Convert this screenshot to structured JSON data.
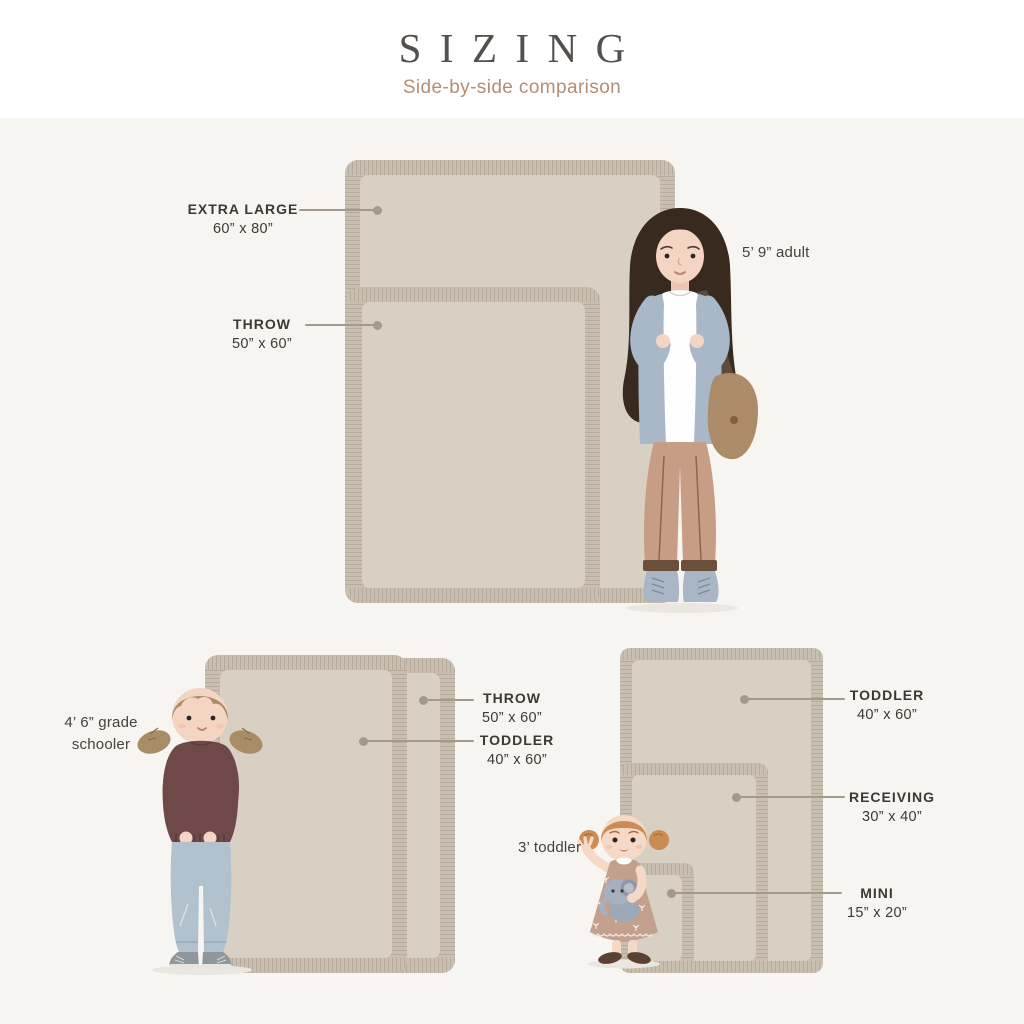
{
  "header": {
    "title": "SIZING",
    "subtitle": "Side-by-side comparison"
  },
  "callouts": {
    "extra_large": {
      "name": "EXTRA LARGE",
      "size": "60” x 80”"
    },
    "throw_top": {
      "name": "THROW",
      "size": "50” x 60”"
    },
    "throw_bl": {
      "name": "THROW",
      "size": "50” x 60”"
    },
    "toddler_bl": {
      "name": "TODDLER",
      "size": "40” x 60”"
    },
    "toddler_br": {
      "name": "TODDLER",
      "size": "40” x 60”"
    },
    "receiving": {
      "name": "RECEIVING",
      "size": "30” x 40”"
    },
    "mini": {
      "name": "MINI",
      "size": "15” x 20”"
    },
    "adult": {
      "label": "5’ 9” adult"
    },
    "schooler": {
      "label": "4’ 6” grade schooler"
    },
    "toddler_person": {
      "label": "3’ toddler"
    }
  },
  "colors": {
    "background": "#f6f5f1",
    "blanket_fringe": "#c9bfb0",
    "blanket_inner": "#d9d0c4",
    "connector": "#a59a89",
    "title": "#55504c",
    "subtitle": "#b18e75",
    "label_text": "#3e3831"
  }
}
